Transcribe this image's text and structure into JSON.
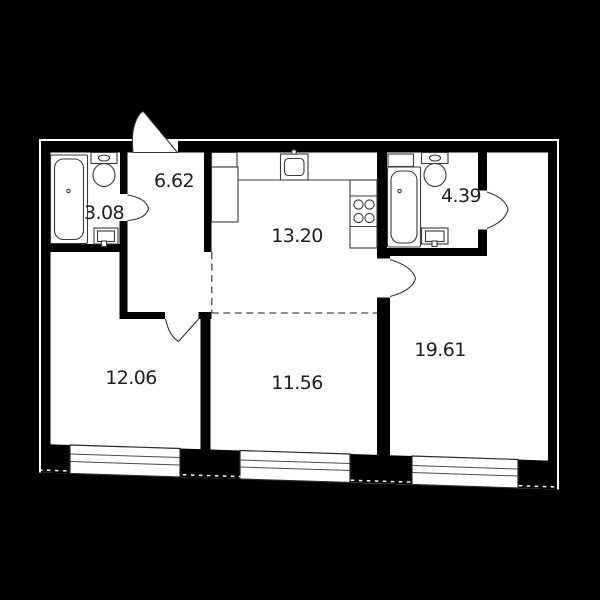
{
  "floor_plan": {
    "colors": {
      "background": "#000000",
      "walls": "#000000",
      "floor": "#ffffff",
      "label_text": "#1e1e1e"
    },
    "rooms": [
      {
        "name": "bathroom-1",
        "area": "3.08"
      },
      {
        "name": "hallway",
        "area": "6.62"
      },
      {
        "name": "kitchen",
        "area": "13.20"
      },
      {
        "name": "bathroom-2",
        "area": "4.39"
      },
      {
        "name": "bedroom-1",
        "area": "12.06"
      },
      {
        "name": "living-room",
        "area": "11.56"
      },
      {
        "name": "bedroom-2",
        "area": "19.61"
      }
    ]
  }
}
